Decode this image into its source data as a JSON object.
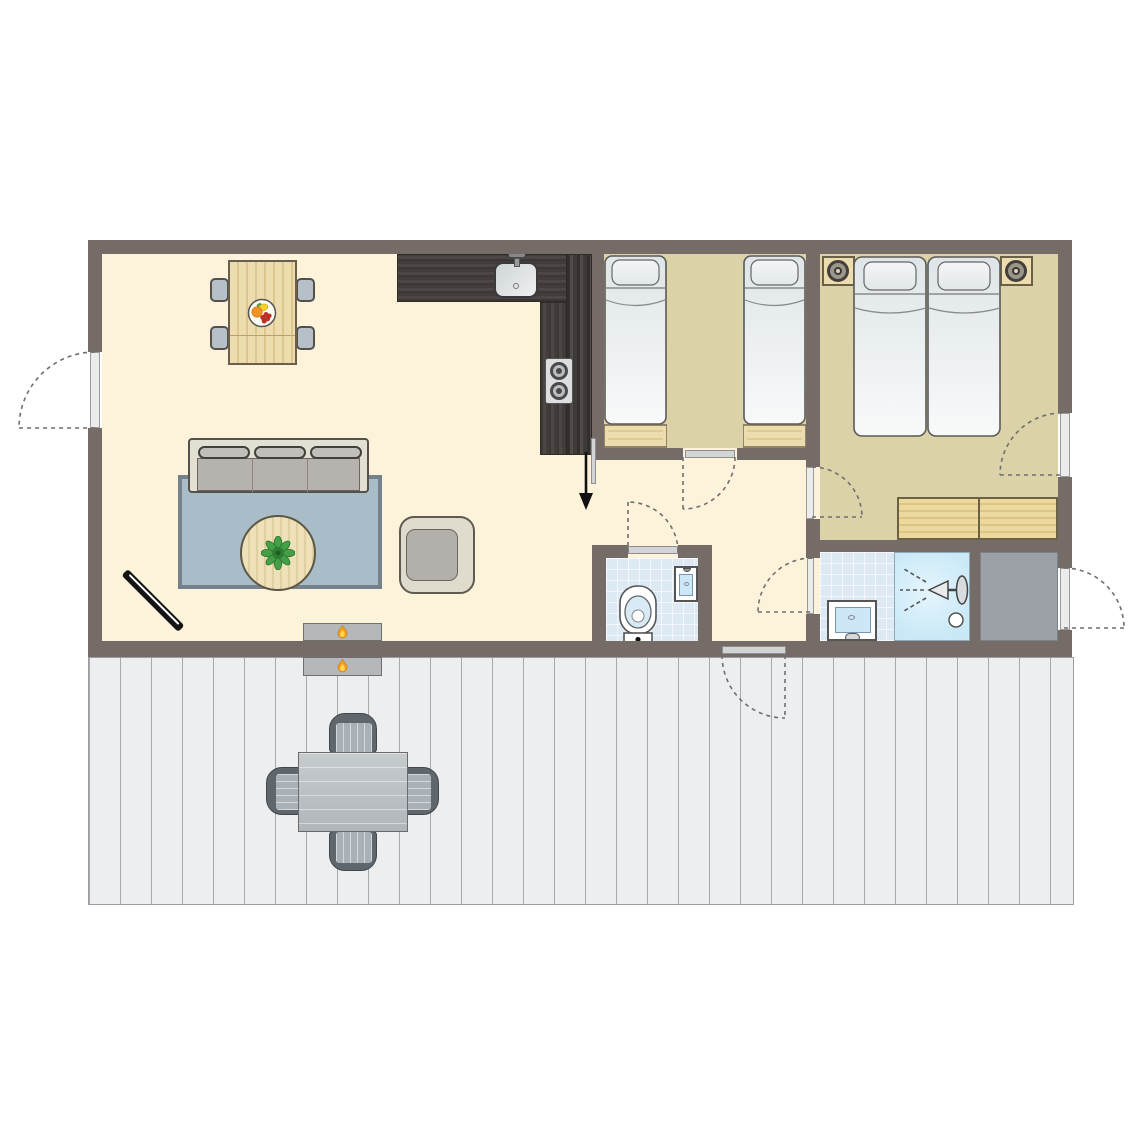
{
  "plan": {
    "type": "holiday-home-floor-plan",
    "rooms": [
      "living-dining-room",
      "kitchen",
      "twin-bedroom",
      "double-bedroom",
      "hallway",
      "toilet-room",
      "bathroom",
      "storage-room",
      "terrace-deck"
    ],
    "doors_count": 8,
    "windows_count": 0,
    "entrance_arrow": true,
    "furniture": {
      "living_dining": [
        "dining-table",
        "dining-chair x4",
        "fruit-bowl",
        "sofa-3-seat",
        "rug",
        "round-coffee-table",
        "potted-plant",
        "armchair",
        "tv-corner"
      ],
      "kitchen": [
        "l-shaped-counter",
        "kitchen-sink",
        "stove-2-burner",
        "tall-cabinet"
      ],
      "twin_bedroom": [
        "single-bed x2",
        "foot-bench x2"
      ],
      "double_bedroom": [
        "double-bed",
        "nightstand x2",
        "lamp x2",
        "dresser"
      ],
      "toilet_room": [
        "toilet",
        "hand-basin"
      ],
      "bathroom": [
        "washbasin",
        "shower-cabin",
        "drain"
      ],
      "terrace": [
        "outdoor-table",
        "outdoor-chair x4",
        "double-sided-fireplace"
      ]
    }
  },
  "colors": {
    "wall": "#756c67",
    "floor_living": "#fdf3da",
    "floor_bedroom": "#dcd2a8",
    "floor_tile": "#dde9f3",
    "shower": "#c9e9f7",
    "storage_floor": "#9ba1a6",
    "deck": "#eceeef",
    "deck_line": "#a7aaac",
    "rug": "#a9bdc9",
    "rug_border": "#75818b",
    "wood_light": "#ecdcae",
    "wood_grain": "#dcc88f",
    "counter_dark": "#45403d",
    "sofa_frame": "#e2dfd3",
    "cushion": "#b6b2ad",
    "chair_gray": "#b6c0c9",
    "outline": "#55504a",
    "outdoor_dark": "#5f676d",
    "outdoor_seat": "#aab1b6",
    "door_leaf": "#ececec",
    "leaf_gray": "#d2d4d5",
    "arc": "#6f6f6f",
    "flame_orange": "#f39c1f",
    "flame_yellow": "#ffd84d",
    "water": "#cde7f6",
    "mattress_top": "#dfe5e8",
    "mattress_bottom": "#f8fafa",
    "plant_green": "#3f8f3a",
    "black": "#141414"
  }
}
